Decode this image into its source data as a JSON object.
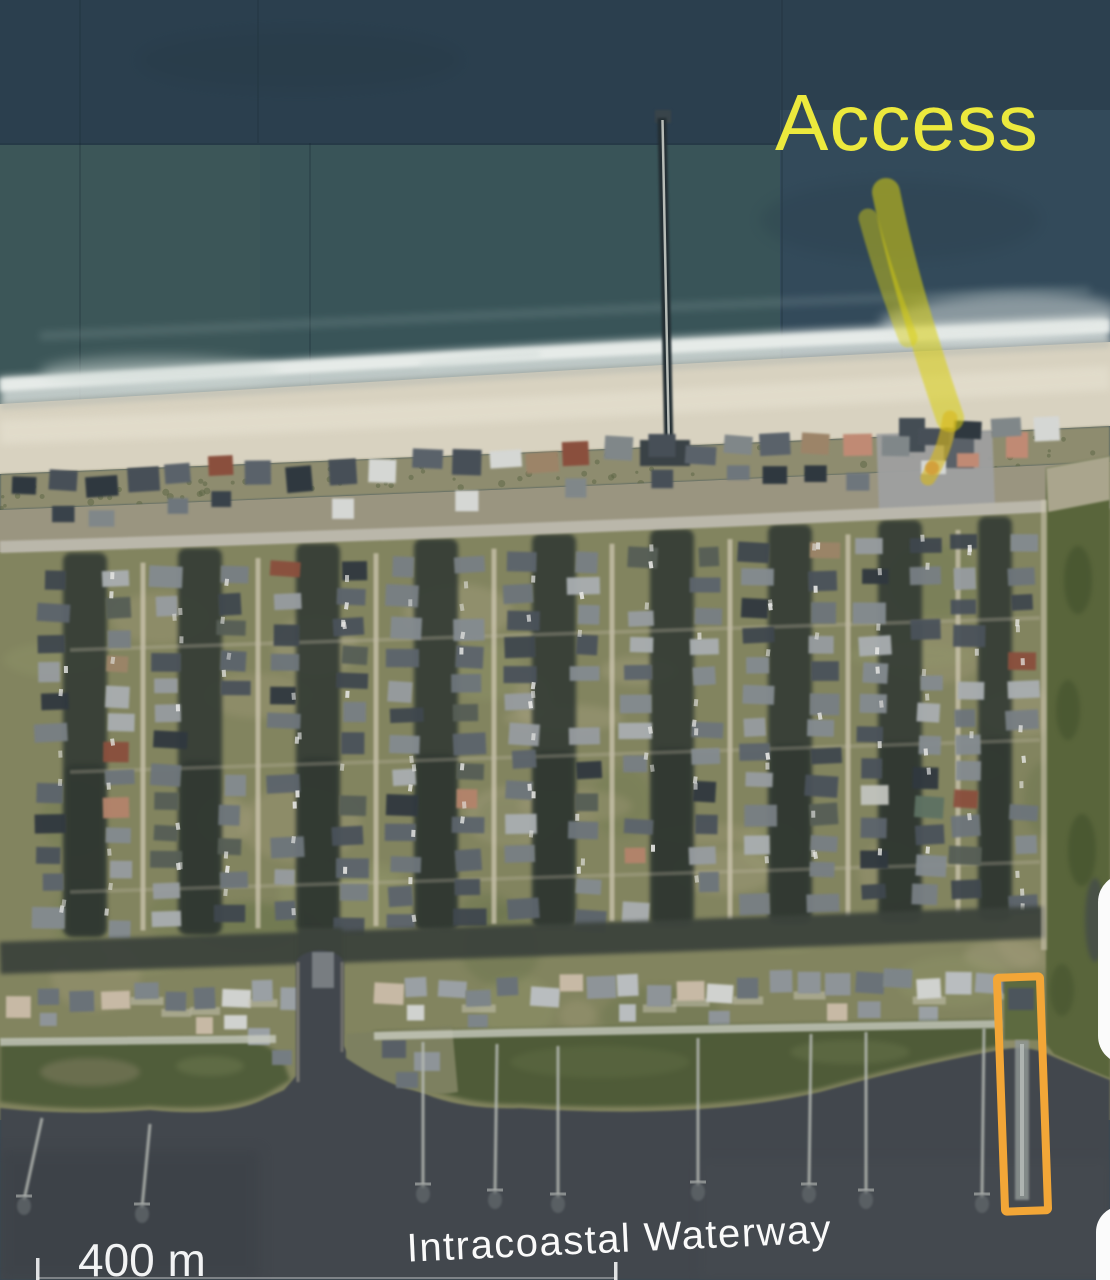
{
  "map": {
    "view": "satellite-aerial-coastal-neighborhood",
    "labels": {
      "waterway": "Intracoastal Waterway",
      "scale": "400 m"
    },
    "annotations": {
      "access_label": "Access",
      "access_color": "#ece93d",
      "arrow_color": "#d9cf10",
      "highlight_box_color": "#f2a637"
    },
    "colors": {
      "ocean": "#2e4654",
      "surf": "#e8ece9",
      "sand": "#d8d2c0",
      "land": "#82845f",
      "intracoastal_water": "#42474d",
      "marsh": "#4f5c39"
    }
  }
}
